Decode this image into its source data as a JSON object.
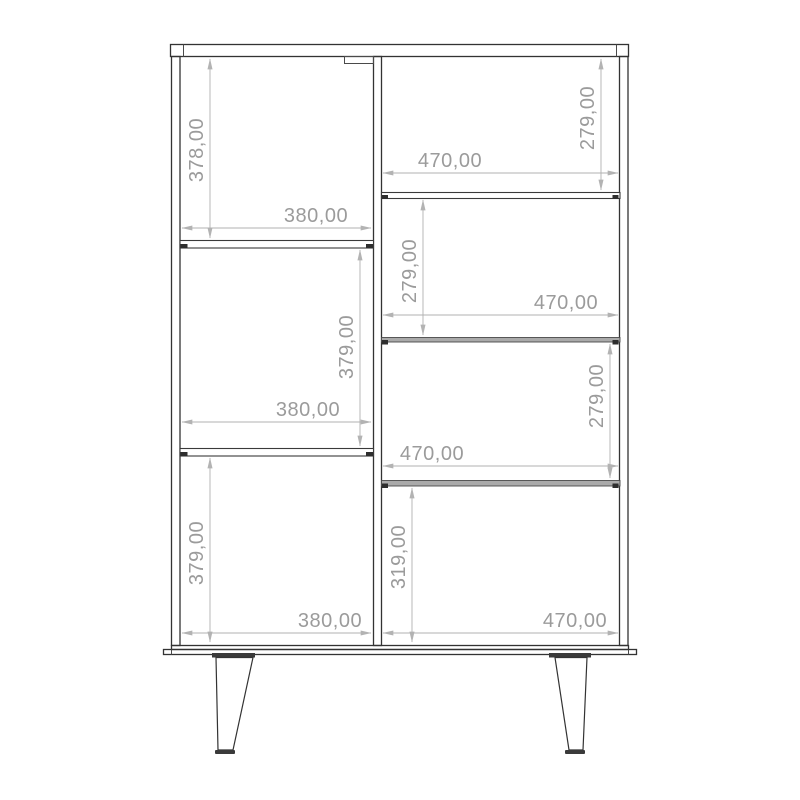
{
  "page": {
    "background": "#ffffff",
    "description": "Technical front-elevation drawing of a two-column cabinet on splayed legs with dimensioned compartments"
  },
  "drawing": {
    "type": "furniture-front-elevation",
    "unit_format": "comma-decimal millimetres",
    "colors": {
      "outline": "#333333",
      "shelf_fill": "#aaaaaa",
      "dimension_line": "#b0b0b0",
      "dimension_text": "#9b9b9b",
      "background": "#ffffff"
    },
    "compartments": [
      {
        "id": "left-top",
        "height": "378,00",
        "width": "380,00"
      },
      {
        "id": "left-middle",
        "height": "379,00",
        "width": "380,00"
      },
      {
        "id": "left-bottom",
        "height": "379,00",
        "width": "380,00"
      },
      {
        "id": "right-1",
        "height": "279,00",
        "width": "470,00"
      },
      {
        "id": "right-2",
        "height": "279,00",
        "width": "470,00"
      },
      {
        "id": "right-3",
        "height": "279,00",
        "width": "470,00"
      },
      {
        "id": "right-4",
        "height": "319,00",
        "width": "470,00"
      }
    ]
  }
}
